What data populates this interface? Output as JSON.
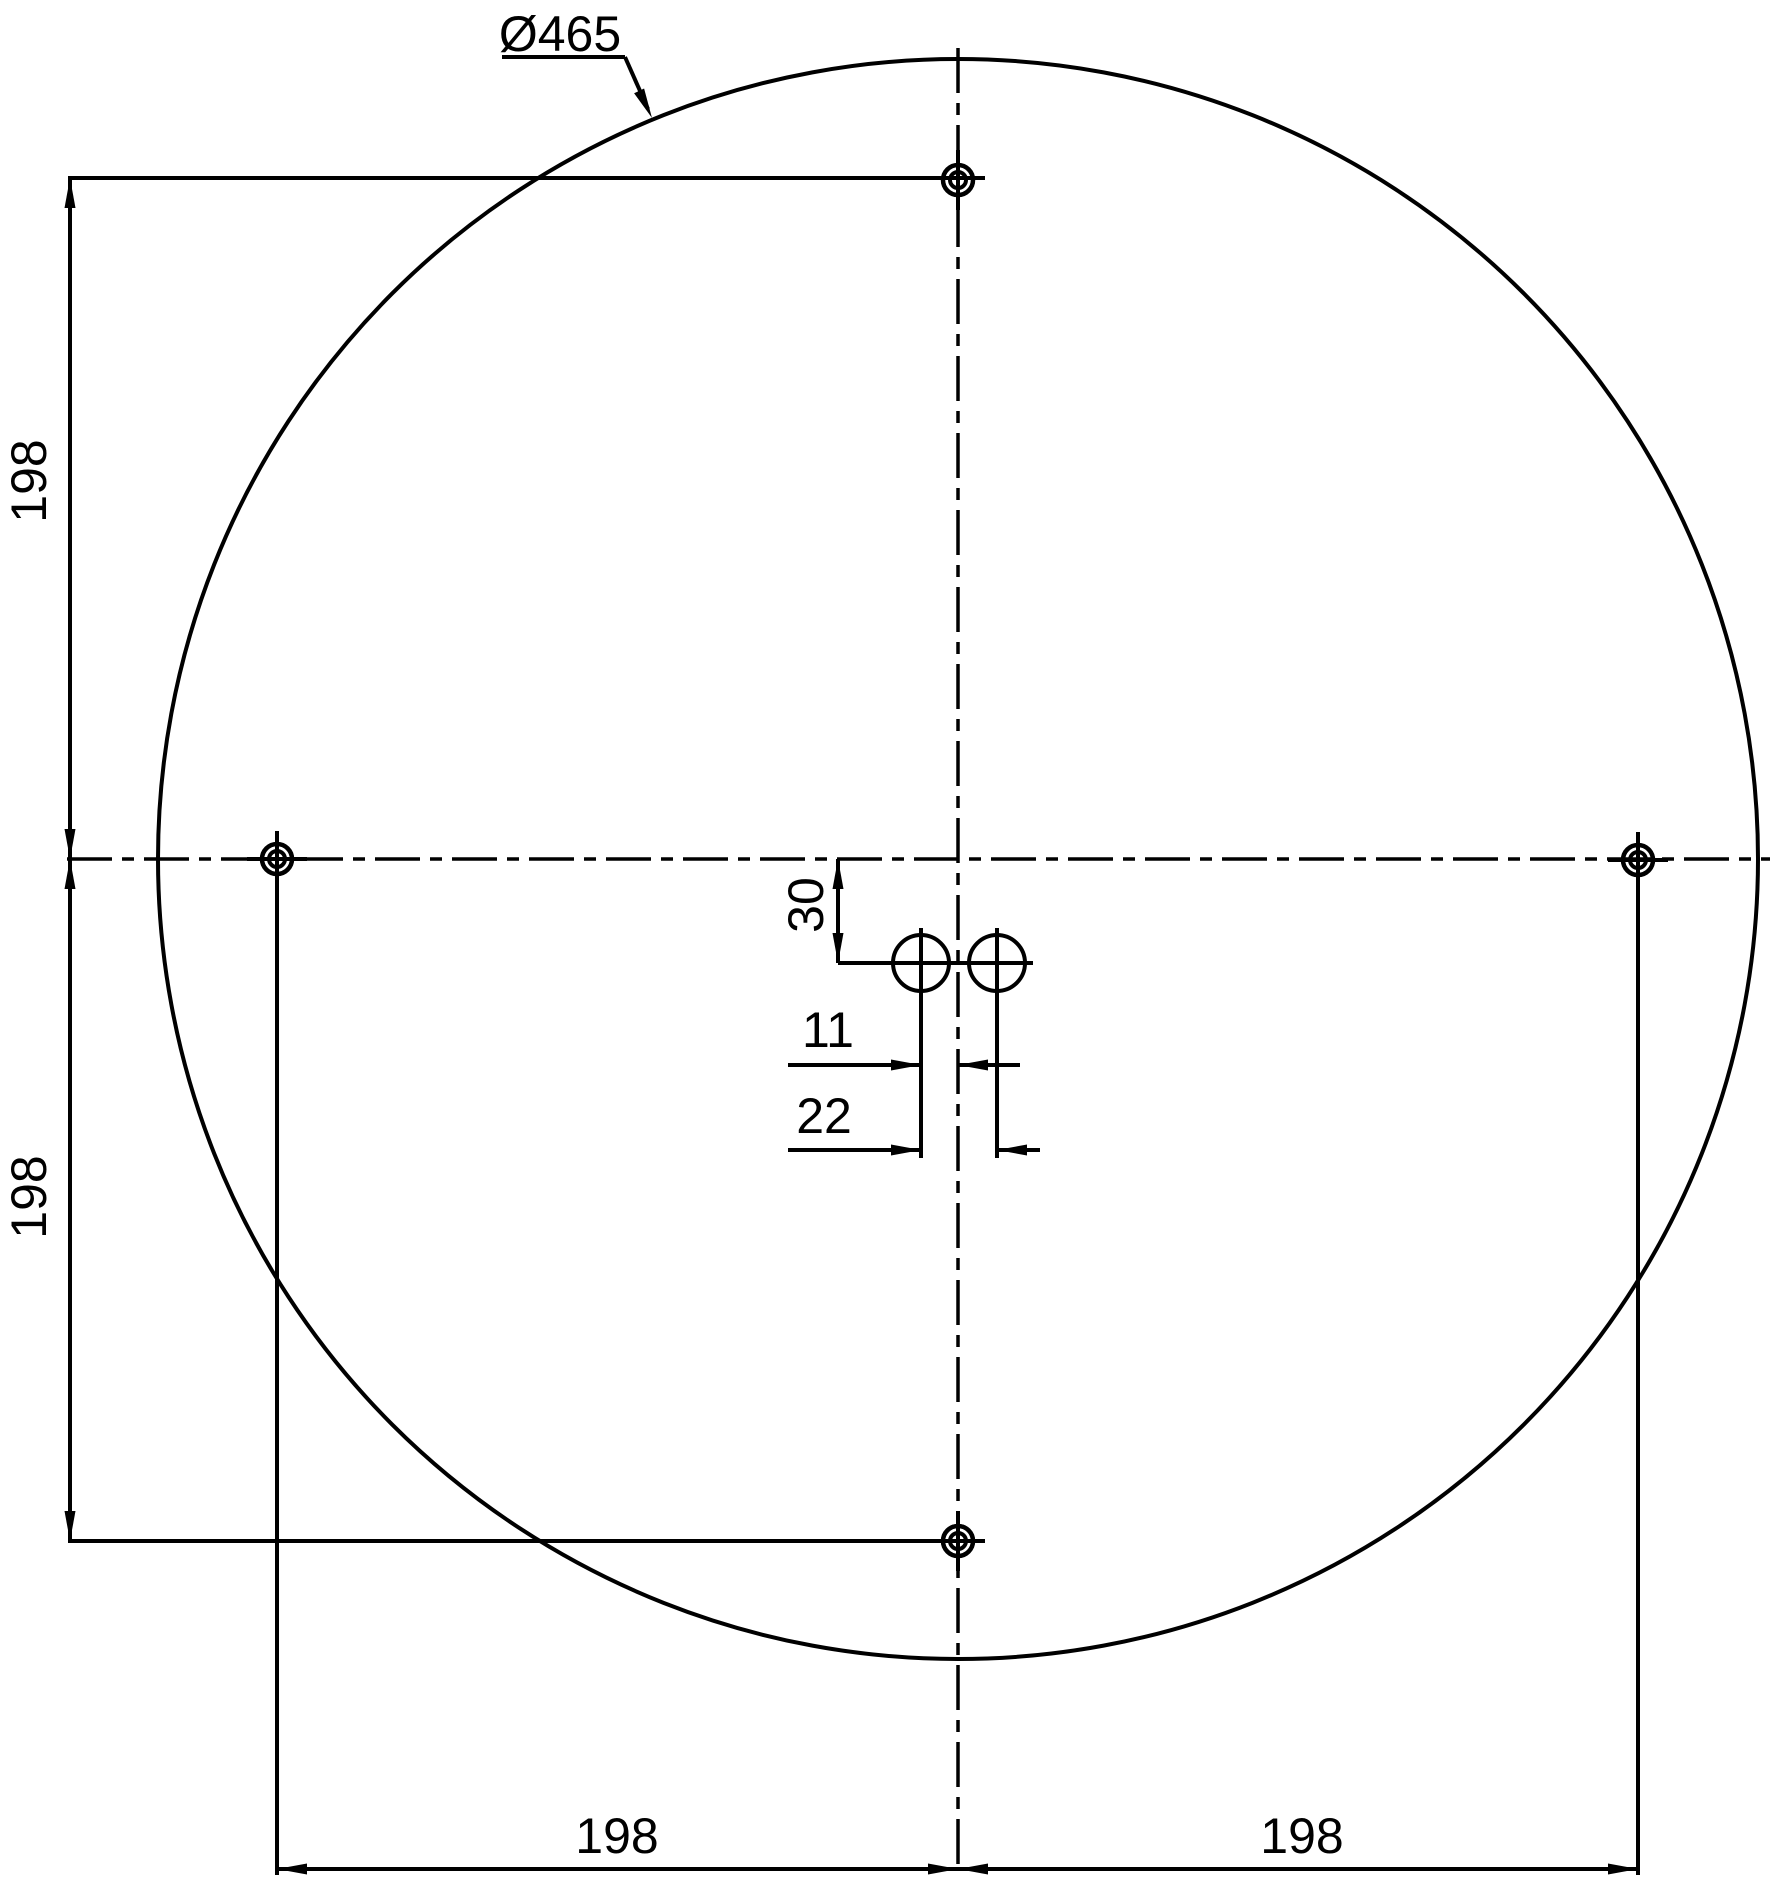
{
  "drawing": {
    "background_color": "#ffffff",
    "line_color": "#000000",
    "labels": {
      "diameter": "Ø465",
      "dim_left_upper": "198",
      "dim_left_lower": "198",
      "dim_bottom_left": "198",
      "dim_bottom_right": "198",
      "dim_center_offset": "30",
      "dim_hole_half_spacing": "11",
      "dim_hole_spacing": "22"
    }
  }
}
